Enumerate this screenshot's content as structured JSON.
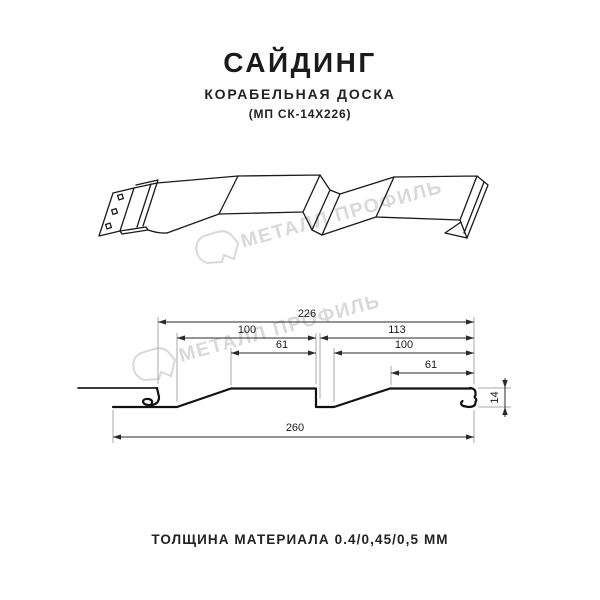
{
  "title": {
    "main": "САЙДИНГ",
    "subtitle": "КОРАБЕЛЬНАЯ ДОСКА",
    "model": "(МП СК-14Х226)"
  },
  "watermark": {
    "text": "МЕТАЛЛ ПРОФИЛЬ",
    "color": "#d9d9d9"
  },
  "drawing": {
    "description": "Perspective sketch and dimensioned cross-section of ship-lap metal siding panel",
    "cross_section_dimensions_mm": {
      "overall_width": 260,
      "coverage_width": 226,
      "left_board_width": 100,
      "left_board_flat": 61,
      "right_board_width": 113,
      "right_board_inner": 100,
      "right_board_flat": 61,
      "profile_depth": 14
    },
    "dim_labels": {
      "d226": "226",
      "d100_left": "100",
      "d61_left": "61",
      "d113": "113",
      "d100_right": "100",
      "d61_right": "61",
      "d260": "260",
      "d14": "14"
    }
  },
  "footer": {
    "thickness": "ТОЛЩИНА МАТЕРИАЛА 0.4/0,45/0,5 ММ"
  }
}
